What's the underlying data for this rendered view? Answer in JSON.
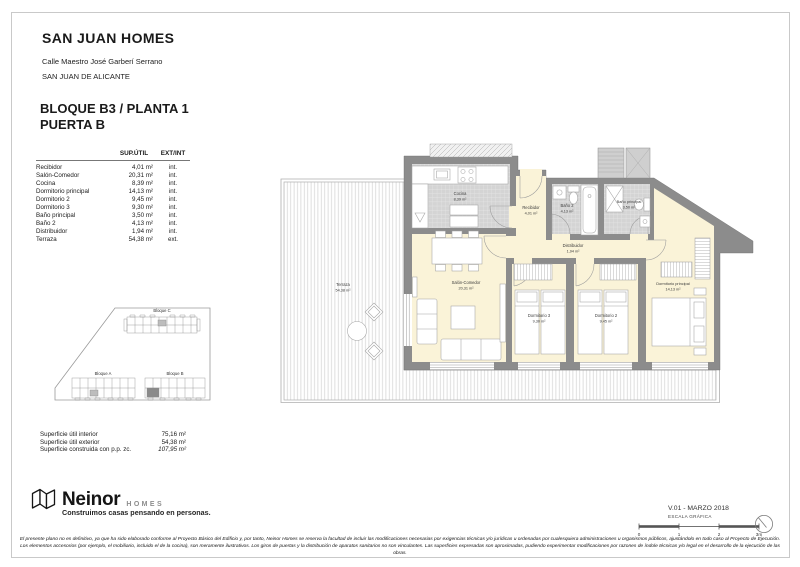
{
  "header": {
    "title": "SAN JUAN HOMES",
    "address": "Calle Maestro José Garberí Serrano",
    "city": "SAN JUAN DE ALICANTE",
    "block_line": "BLOQUE B3 / PLANTA 1\nPUERTA B"
  },
  "areas_table": {
    "col_area": "SUP.ÚTIL",
    "col_extint": "EXT/INT",
    "rows": [
      {
        "room": "Recibidor",
        "area": "4,01 m²",
        "loc": "int."
      },
      {
        "room": "Salón-Comedor",
        "area": "20,31 m²",
        "loc": "int."
      },
      {
        "room": "Cocina",
        "area": "8,39 m²",
        "loc": "int."
      },
      {
        "room": "Dormitorio principal",
        "area": "14,13 m²",
        "loc": "int."
      },
      {
        "room": "Dormitorio 2",
        "area": "9,45 m²",
        "loc": "int."
      },
      {
        "room": "Dormitorio 3",
        "area": "9,30 m²",
        "loc": "int."
      },
      {
        "room": "Baño principal",
        "area": "3,50 m²",
        "loc": "int."
      },
      {
        "room": "Baño 2",
        "area": "4,13 m²",
        "loc": "int."
      },
      {
        "room": "Distribuidor",
        "area": "1,94 m²",
        "loc": "int."
      },
      {
        "room": "Terraza",
        "area": "54,38 m²",
        "loc": "ext."
      }
    ]
  },
  "site_plan": {
    "bloque_a": "Bloque A",
    "bloque_b": "Bloque B",
    "bloque_c": "Bloque C"
  },
  "summary": [
    {
      "label": "Superficie útil interior",
      "value": "75,16 m²"
    },
    {
      "label": "Superficie útil exterior",
      "value": "54,38 m²"
    },
    {
      "label": "Superficie construida con p.p. zc.",
      "value": "107,95 m²"
    }
  ],
  "floor_plan": {
    "rooms": [
      {
        "label": "Cocina",
        "area": "8,39 m²"
      },
      {
        "label": "Recibidor",
        "area": "4,01 m²"
      },
      {
        "label": "Baño 2",
        "area": "4,13 m²"
      },
      {
        "label": "Baño principal",
        "area": "3,50 m²"
      },
      {
        "label": "Distribuidor",
        "area": "1,94 m²"
      },
      {
        "label": "Salón-Comedor",
        "area": "20,31 m²"
      },
      {
        "label": "Dormitorio 3",
        "area": "9,30 m²"
      },
      {
        "label": "Dormitorio 2",
        "area": "9,45 m²"
      },
      {
        "label": "Dormitorio principal",
        "area": "14,13 m²"
      },
      {
        "label": "Terraza",
        "area": "54,38 m²"
      }
    ]
  },
  "footer": {
    "brand": "Neinor",
    "brand_suffix": "HOMES",
    "tagline": "Construimos casas pensando en personas.",
    "version": "V.01 - MARZO 2018",
    "scale_label": "ESCALA GRÁFICA",
    "scale_ticks": [
      "0",
      "1",
      "2",
      "3m"
    ],
    "disclaimer_line1": "El presente plano no es definitivo, ya que ha sido elaborado conforme al Proyecto Básico del Edificio y, por tanto, Neinor Homes se reserva la facultad de incluir las modificaciones necesarias por exigencias técnicas y/o jurídicas u ordenadas por cualesquiera administraciones u organismos públicos, ajustándolo en todo caso al Proyecto de Ejecución.",
    "disclaimer_line2": "Los elementos accesorios (por ejemplo, el mobiliario, incluido el de la cocina), son meramente ilustrativos. Los giros de puertas y la distribución de aparatos sanitarios no son vinculantes. Las superficies expresadas son aproximadas, pudiendo experimentar modificaciones por razones de índole técnicas y/o legal en el desarrollo de la ejecución de las obras."
  },
  "colors": {
    "wall_gray": "#8c8c8c",
    "room_fill": "#faf3d8",
    "tile_fill": "#d4d4d4",
    "brand_black": "#151515"
  }
}
